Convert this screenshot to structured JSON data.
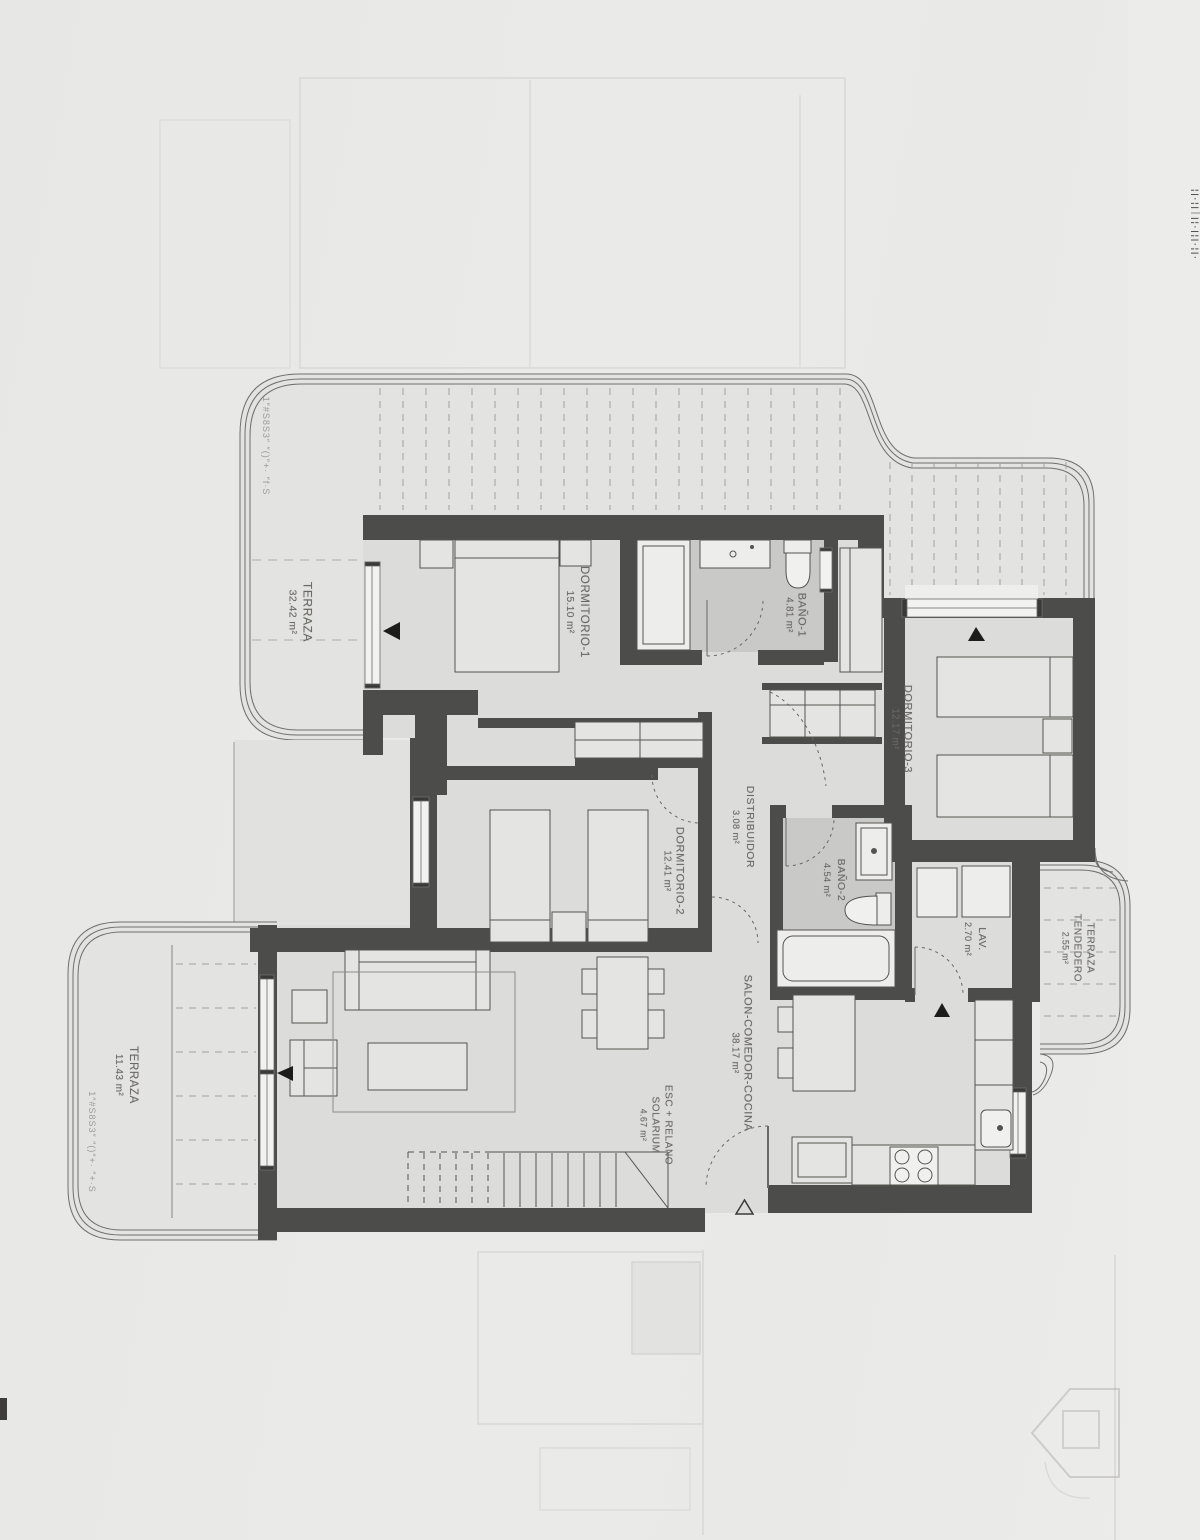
{
  "document": {
    "type": "architectural-floor-plan-scan",
    "language": "es",
    "units": "m²"
  },
  "colors": {
    "paper": "#e9e9e7",
    "wall": "#4c4c4a",
    "room_floor": "#dcdcdb",
    "bath_floor": "#c9c9c7",
    "terrace_floor": "#e3e3e1",
    "label_text": "#6b6965"
  },
  "rooms": [
    {
      "id": "terraza-top",
      "name": "TERRAZA",
      "area": "32.42 m²"
    },
    {
      "id": "dormitorio-1",
      "name": "DORMITORIO-1",
      "area": "15.10 m²"
    },
    {
      "id": "bano-1",
      "name": "BAÑO-1",
      "area": "4.81 m²"
    },
    {
      "id": "dormitorio-3",
      "name": "DORMITORIO-3",
      "area": "12.17 m²"
    },
    {
      "id": "distribuidor",
      "name": "DISTRIBUIDOR",
      "area": "3.08 m²"
    },
    {
      "id": "dormitorio-2",
      "name": "DORMITORIO-2",
      "area": "12.41 m²"
    },
    {
      "id": "bano-2",
      "name": "BAÑO-2",
      "area": "4.54 m²"
    },
    {
      "id": "lavadero",
      "name": "LAV.",
      "area": "2.70 m²"
    },
    {
      "id": "terraza-tendedero",
      "name": "TERRAZA",
      "name2": "TENDEDERO",
      "area": "2.55 m²"
    },
    {
      "id": "salon-comedor-cocina",
      "name": "SALON-COMEDOR-COCINA",
      "area": "38.17 m²"
    },
    {
      "id": "escalera-solarium",
      "name": "ESC + RELANO",
      "name2": "SOLARIUM",
      "area": "4.67 m²"
    },
    {
      "id": "terraza-left",
      "name": "TERRAZA",
      "area": "11.43 m²"
    }
  ],
  "edge_annotations": {
    "top_left": "1″#S8S3″ ″()″+· ″f·S",
    "bottom_left": "1″#S8S3″ ″()″+· ″+·S",
    "right_edge": "¦|·¦|׀|¦·|¦|·¦|·"
  },
  "watermarks": [
    "house-logo-bleedthrough"
  ]
}
